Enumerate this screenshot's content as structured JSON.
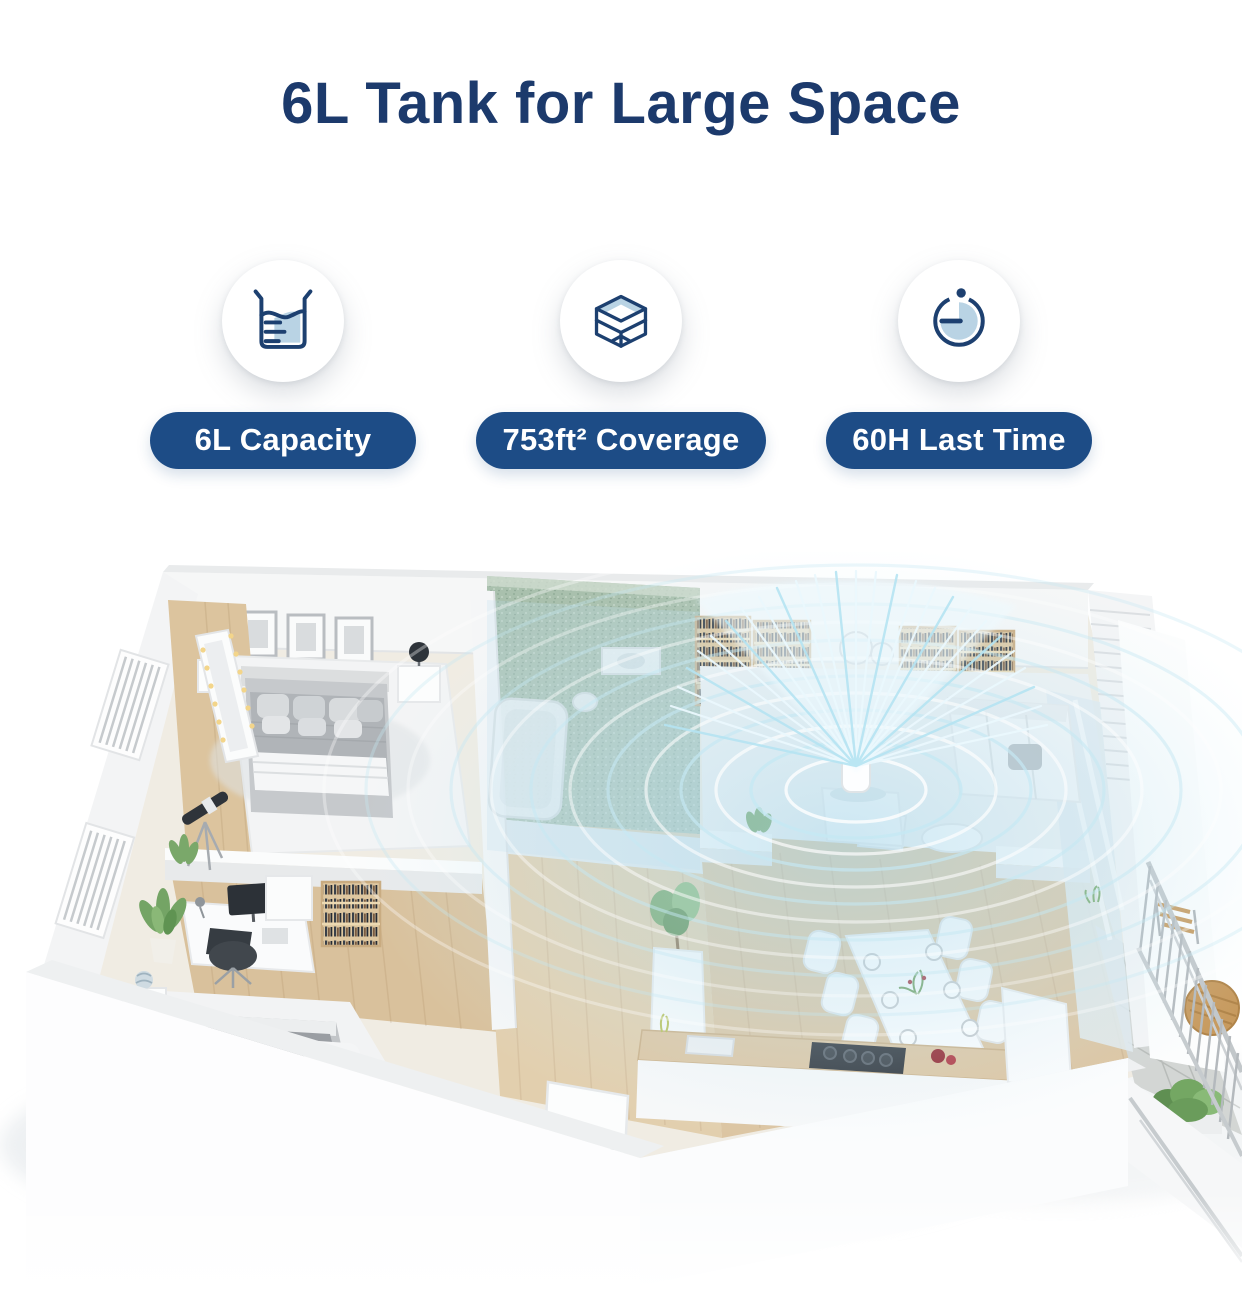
{
  "header": {
    "title": "6L Tank for Large Space"
  },
  "features": [
    {
      "icon": "beaker-icon",
      "label": "6L Capacity"
    },
    {
      "icon": "coverage-cube-icon",
      "label": "753ft² Coverage"
    },
    {
      "icon": "timer-icon",
      "label": "60H Last Time"
    }
  ],
  "theme": {
    "background": "#ffffff",
    "title_color": "#1c3a6c",
    "badge_bg": "#1d4c86",
    "badge_text": "#ffffff",
    "icon_navy": "#1d4070",
    "icon_light_blue": "#b9d3e4",
    "mist_color": "#c6e9f4",
    "wood_color": "#dcc5a2",
    "tile_green": "#a9c0ad"
  },
  "floorplan": {
    "alt": "3D isometric apartment floor plan: humidifier in living room spreading mist over bedroom, office, bathroom, dining area, kitchen and balcony",
    "device": "humidifier"
  }
}
